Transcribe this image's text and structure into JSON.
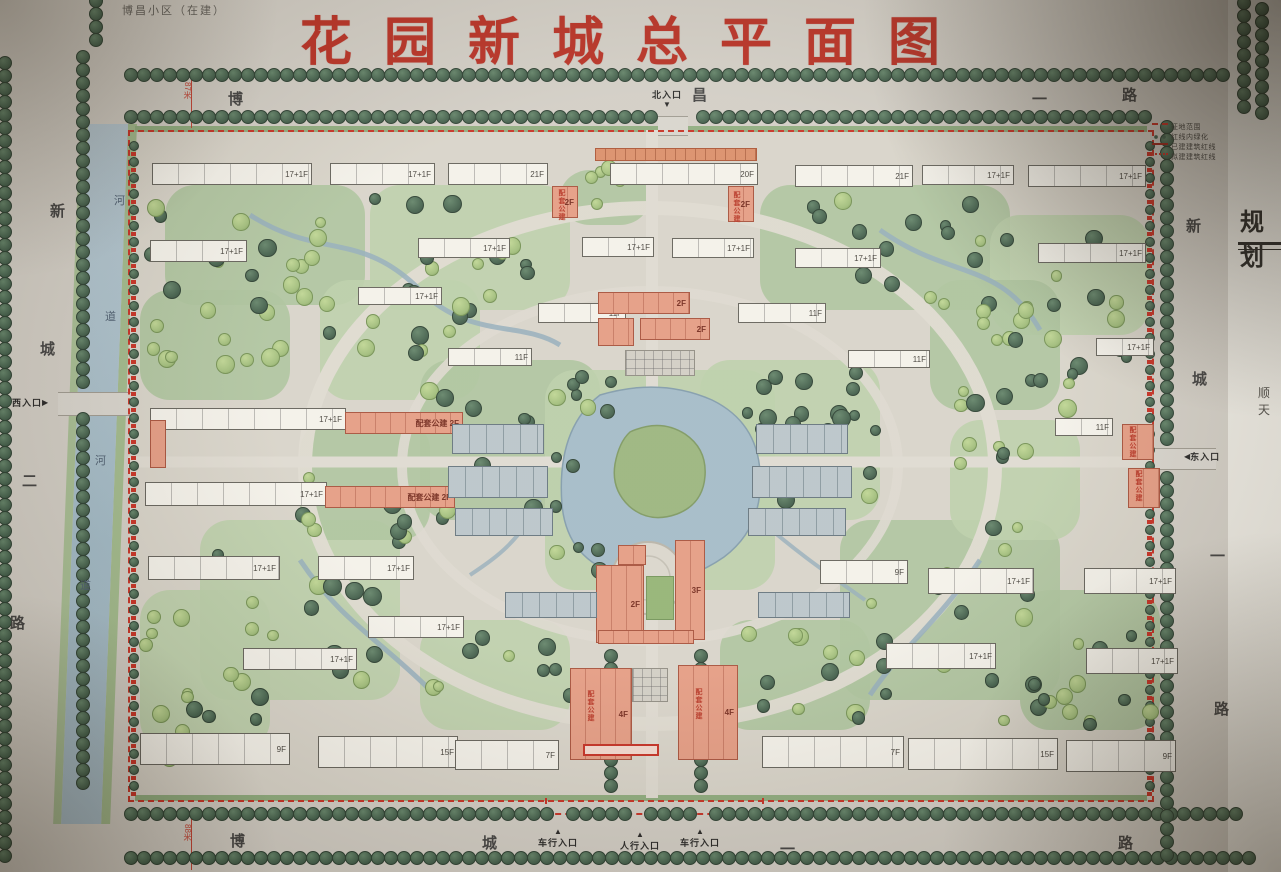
{
  "title": "花园新城总平面图",
  "subtitle": "博昌小区（在建）",
  "legend": {
    "items": [
      {
        "symbol": "red-dashed-line",
        "label": "征地范围"
      },
      {
        "symbol": "green-tree-row",
        "label": "红线内绿化"
      },
      {
        "symbol": "red-solid-line",
        "label": "已建建筑红线"
      },
      {
        "symbol": "red-dotted-line",
        "label": "拟建建筑红线"
      }
    ]
  },
  "side_panel": {
    "title": "规划",
    "note": "顺天"
  },
  "colors": {
    "title_red": "#b5281c",
    "boundary_red": "#c4281c",
    "water_blue": "#a7becb",
    "tree_dark": "#3c5a46",
    "tree_light": "#9dbb77",
    "building_pink": "#e3987f",
    "building_white": "#f3f1ea",
    "townhouse_grey": "#b7c3c9"
  },
  "map": {
    "road_labels": [
      {
        "text": "博",
        "x": 228,
        "y": 88
      },
      {
        "text": "昌",
        "x": 692,
        "y": 84
      },
      {
        "text": "一",
        "x": 1032,
        "y": 88
      },
      {
        "text": "路",
        "x": 1122,
        "y": 84
      },
      {
        "text": "新",
        "x": 50,
        "y": 200
      },
      {
        "text": "城",
        "x": 40,
        "y": 338
      },
      {
        "text": "二",
        "x": 22,
        "y": 470
      },
      {
        "text": "路",
        "x": 10,
        "y": 612
      },
      {
        "text": "新",
        "x": 1186,
        "y": 215
      },
      {
        "text": "城",
        "x": 1192,
        "y": 368
      },
      {
        "text": "一",
        "x": 1210,
        "y": 545
      },
      {
        "text": "路",
        "x": 1214,
        "y": 698
      },
      {
        "text": "博",
        "x": 230,
        "y": 830
      },
      {
        "text": "城",
        "x": 482,
        "y": 832
      },
      {
        "text": "一",
        "x": 780,
        "y": 838
      },
      {
        "text": "路",
        "x": 1118,
        "y": 832
      }
    ],
    "river_labels": [
      {
        "text": "河",
        "x": 114,
        "y": 192
      },
      {
        "text": "道",
        "x": 105,
        "y": 308
      },
      {
        "text": "河",
        "x": 95,
        "y": 452
      },
      {
        "text": "道",
        "x": 80,
        "y": 577
      }
    ],
    "measurements": [
      {
        "text": "87米",
        "x": 182,
        "y": 82
      },
      {
        "text": "88米",
        "x": 182,
        "y": 824
      }
    ],
    "entrances": [
      {
        "text": "北入口",
        "arrow": "▼",
        "pos": "n",
        "x": 652,
        "y": 88
      },
      {
        "text": "西入口",
        "arrow": "▶",
        "pos": "w",
        "x": 12,
        "y": 396
      },
      {
        "text": "东入口",
        "arrow": "◀",
        "pos": "e",
        "x": 1184,
        "y": 450
      },
      {
        "text": "车行入口",
        "arrow": "▲",
        "pos": "s",
        "x": 538,
        "y": 828
      },
      {
        "text": "人行入口",
        "arrow": "▲",
        "pos": "s",
        "x": 620,
        "y": 831
      },
      {
        "text": "车行入口",
        "arrow": "▲",
        "pos": "s",
        "x": 680,
        "y": 828
      }
    ],
    "vtexts": [
      {
        "text": "配套公建",
        "x": 556,
        "y": 189
      },
      {
        "text": "配套公建",
        "x": 731,
        "y": 191
      },
      {
        "text": "配套公建",
        "x": 585,
        "y": 690
      },
      {
        "text": "配套公建",
        "x": 693,
        "y": 688
      },
      {
        "text": "配套公建",
        "x": 1127,
        "y": 426
      },
      {
        "text": "配套公建",
        "x": 1133,
        "y": 470
      }
    ],
    "buildings": [
      {
        "t": "w",
        "x": 152,
        "y": 163,
        "w": 160,
        "h": 22,
        "l": "17+1F"
      },
      {
        "t": "w",
        "x": 330,
        "y": 163,
        "w": 105,
        "h": 22,
        "l": "17+1F"
      },
      {
        "t": "w",
        "x": 448,
        "y": 163,
        "w": 100,
        "h": 22,
        "l": "21F"
      },
      {
        "t": "w",
        "x": 610,
        "y": 163,
        "w": 148,
        "h": 22,
        "l": "20F"
      },
      {
        "t": "w",
        "x": 795,
        "y": 165,
        "w": 118,
        "h": 22,
        "l": "21F"
      },
      {
        "t": "w",
        "x": 922,
        "y": 165,
        "w": 92,
        "h": 20,
        "l": "17+1F"
      },
      {
        "t": "w",
        "x": 1028,
        "y": 165,
        "w": 118,
        "h": 22,
        "l": "17+1F"
      },
      {
        "t": "w",
        "x": 150,
        "y": 240,
        "w": 97,
        "h": 22,
        "l": "17+1F"
      },
      {
        "t": "w",
        "x": 418,
        "y": 238,
        "w": 92,
        "h": 20,
        "l": "17+1F"
      },
      {
        "t": "w",
        "x": 582,
        "y": 237,
        "w": 72,
        "h": 20,
        "l": "17+1F"
      },
      {
        "t": "w",
        "x": 672,
        "y": 238,
        "w": 82,
        "h": 20,
        "l": "17+1F"
      },
      {
        "t": "w",
        "x": 795,
        "y": 248,
        "w": 86,
        "h": 20,
        "l": "17+1F"
      },
      {
        "t": "w",
        "x": 1038,
        "y": 243,
        "w": 108,
        "h": 20,
        "l": "17+1F"
      },
      {
        "t": "w",
        "x": 1096,
        "y": 338,
        "w": 58,
        "h": 18,
        "l": "17+1F"
      },
      {
        "t": "w",
        "x": 358,
        "y": 287,
        "w": 84,
        "h": 18,
        "l": "17+1F"
      },
      {
        "t": "w",
        "x": 448,
        "y": 348,
        "w": 84,
        "h": 18,
        "l": "11F"
      },
      {
        "t": "w",
        "x": 538,
        "y": 303,
        "w": 88,
        "h": 20,
        "l": "11F"
      },
      {
        "t": "w",
        "x": 738,
        "y": 303,
        "w": 88,
        "h": 20,
        "l": "11F"
      },
      {
        "t": "w",
        "x": 848,
        "y": 350,
        "w": 82,
        "h": 18,
        "l": "11F"
      },
      {
        "t": "w",
        "x": 1055,
        "y": 418,
        "w": 58,
        "h": 18,
        "l": "11F"
      },
      {
        "t": "w",
        "x": 150,
        "y": 408,
        "w": 196,
        "h": 22,
        "l": "17+1F"
      },
      {
        "t": "w",
        "x": 145,
        "y": 482,
        "w": 182,
        "h": 24,
        "l": "17+1F"
      },
      {
        "t": "w",
        "x": 148,
        "y": 556,
        "w": 132,
        "h": 24,
        "l": "17+1F"
      },
      {
        "t": "w",
        "x": 318,
        "y": 556,
        "w": 96,
        "h": 24,
        "l": "17+1F"
      },
      {
        "t": "w",
        "x": 368,
        "y": 616,
        "w": 96,
        "h": 22,
        "l": "17+1F"
      },
      {
        "t": "w",
        "x": 243,
        "y": 648,
        "w": 114,
        "h": 22,
        "l": "17+1F"
      },
      {
        "t": "w",
        "x": 820,
        "y": 560,
        "w": 88,
        "h": 24,
        "l": "9F"
      },
      {
        "t": "w",
        "x": 928,
        "y": 568,
        "w": 106,
        "h": 26,
        "l": "17+1F"
      },
      {
        "t": "w",
        "x": 1084,
        "y": 568,
        "w": 92,
        "h": 26,
        "l": "17+1F"
      },
      {
        "t": "w",
        "x": 886,
        "y": 643,
        "w": 110,
        "h": 26,
        "l": "17+1F"
      },
      {
        "t": "w",
        "x": 1086,
        "y": 648,
        "w": 92,
        "h": 26,
        "l": "17+1F"
      },
      {
        "t": "w",
        "x": 140,
        "y": 733,
        "w": 150,
        "h": 32,
        "l": "9F"
      },
      {
        "t": "w",
        "x": 318,
        "y": 736,
        "w": 140,
        "h": 32,
        "l": "15F"
      },
      {
        "t": "w",
        "x": 455,
        "y": 740,
        "w": 104,
        "h": 30,
        "l": "7F"
      },
      {
        "t": "w",
        "x": 762,
        "y": 736,
        "w": 142,
        "h": 32,
        "l": "7F"
      },
      {
        "t": "w",
        "x": 908,
        "y": 738,
        "w": 150,
        "h": 32,
        "l": "15F"
      },
      {
        "t": "w",
        "x": 1066,
        "y": 740,
        "w": 110,
        "h": 32,
        "l": "9F"
      },
      {
        "t": "p",
        "x": 552,
        "y": 186,
        "w": 26,
        "h": 32,
        "l": "2F"
      },
      {
        "t": "p",
        "x": 728,
        "y": 186,
        "w": 26,
        "h": 36,
        "l": "2F"
      },
      {
        "t": "p",
        "x": 598,
        "y": 292,
        "w": 92,
        "h": 22,
        "l": "2F"
      },
      {
        "t": "p",
        "x": 640,
        "y": 318,
        "w": 70,
        "h": 22,
        "l": "2F"
      },
      {
        "t": "p",
        "x": 598,
        "y": 318,
        "w": 36,
        "h": 28,
        "l": ""
      },
      {
        "t": "p",
        "x": 345,
        "y": 412,
        "w": 118,
        "h": 22,
        "l": "配套公建 2F"
      },
      {
        "t": "p",
        "x": 325,
        "y": 486,
        "w": 130,
        "h": 22,
        "l": "配套公建 2F"
      },
      {
        "t": "p",
        "x": 150,
        "y": 420,
        "w": 16,
        "h": 48,
        "l": ""
      },
      {
        "t": "p",
        "x": 675,
        "y": 540,
        "w": 30,
        "h": 100,
        "l": "3F"
      },
      {
        "t": "p",
        "x": 596,
        "y": 565,
        "w": 48,
        "h": 78,
        "l": "2F"
      },
      {
        "t": "p",
        "x": 598,
        "y": 630,
        "w": 96,
        "h": 14,
        "l": ""
      },
      {
        "t": "p",
        "x": 618,
        "y": 545,
        "w": 28,
        "h": 20,
        "l": ""
      },
      {
        "t": "p",
        "x": 570,
        "y": 668,
        "w": 62,
        "h": 92,
        "l": "4F"
      },
      {
        "t": "p",
        "x": 678,
        "y": 665,
        "w": 60,
        "h": 95,
        "l": "4F"
      },
      {
        "t": "p",
        "x": 1122,
        "y": 424,
        "w": 32,
        "h": 36,
        "l": ""
      },
      {
        "t": "p",
        "x": 1128,
        "y": 468,
        "w": 32,
        "h": 40,
        "l": ""
      },
      {
        "t": "g",
        "x": 452,
        "y": 424,
        "w": 92,
        "h": 30,
        "l": ""
      },
      {
        "t": "g",
        "x": 448,
        "y": 466,
        "w": 100,
        "h": 32,
        "l": ""
      },
      {
        "t": "g",
        "x": 455,
        "y": 508,
        "w": 98,
        "h": 28,
        "l": ""
      },
      {
        "t": "g",
        "x": 756,
        "y": 424,
        "w": 92,
        "h": 30,
        "l": ""
      },
      {
        "t": "g",
        "x": 752,
        "y": 466,
        "w": 100,
        "h": 32,
        "l": ""
      },
      {
        "t": "g",
        "x": 748,
        "y": 508,
        "w": 98,
        "h": 28,
        "l": ""
      },
      {
        "t": "g",
        "x": 505,
        "y": 592,
        "w": 92,
        "h": 26,
        "l": ""
      },
      {
        "t": "g",
        "x": 758,
        "y": 592,
        "w": 92,
        "h": 26,
        "l": ""
      },
      {
        "t": "tr",
        "x": 625,
        "y": 350,
        "w": 70,
        "h": 26,
        "l": ""
      },
      {
        "t": "tr",
        "x": 632,
        "y": 668,
        "w": 36,
        "h": 34,
        "l": ""
      },
      {
        "t": "court",
        "x": 646,
        "y": 576,
        "w": 28,
        "h": 44,
        "l": ""
      },
      {
        "t": "a",
        "x": 595,
        "y": 148,
        "w": 162,
        "h": 13,
        "l": ""
      },
      {
        "t": "rb",
        "x": 583,
        "y": 744,
        "w": 76,
        "h": 12,
        "l": ""
      }
    ]
  }
}
